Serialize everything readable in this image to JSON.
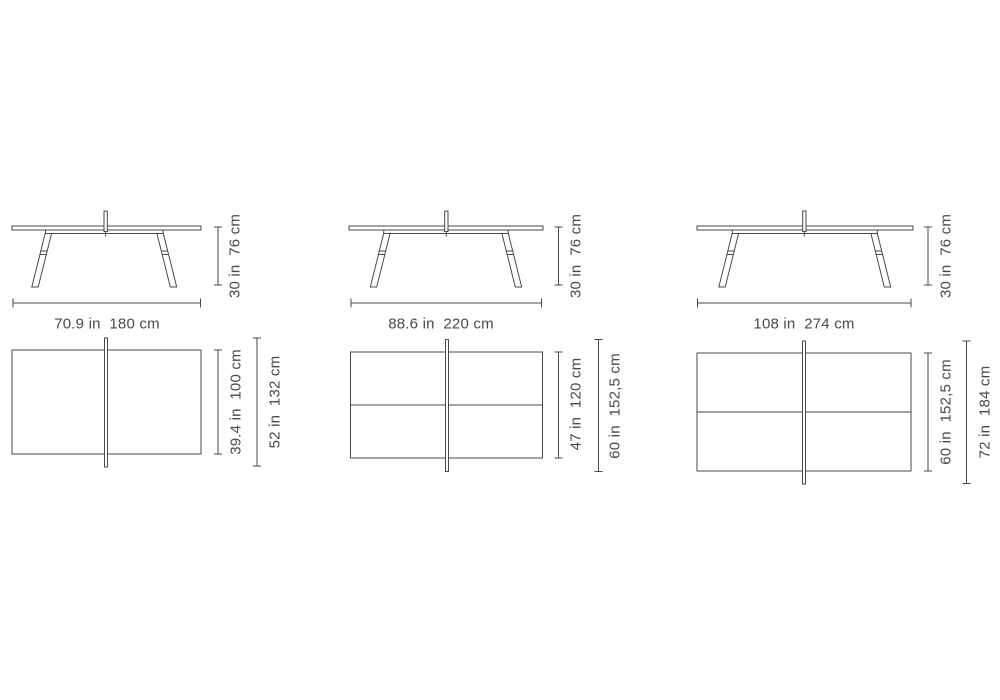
{
  "title": "Ping pong table dimension diagram, three sizes, side and top views",
  "colors": {
    "line": "#4a4a4a",
    "text": "#4a4a4a",
    "background": "#ffffff"
  },
  "tables": [
    {
      "name": "table-180",
      "side": {
        "width_label": "70.9 in  180 cm",
        "height_label": "30 in  76 cm"
      },
      "top": {
        "width_label": "39.4 in  100 cm",
        "net_label": "52 in  132 cm"
      }
    },
    {
      "name": "table-220",
      "side": {
        "width_label": "88.6 in  220 cm",
        "height_label": "30 in  76 cm"
      },
      "top": {
        "width_label": "47 in  120 cm",
        "net_label": "60 in  152,5 cm"
      }
    },
    {
      "name": "table-274",
      "side": {
        "width_label": "108 in  274 cm",
        "height_label": "30 in  76 cm"
      },
      "top": {
        "width_label": "60 in  152,5 cm",
        "net_label": "72 in  184 cm"
      }
    }
  ]
}
